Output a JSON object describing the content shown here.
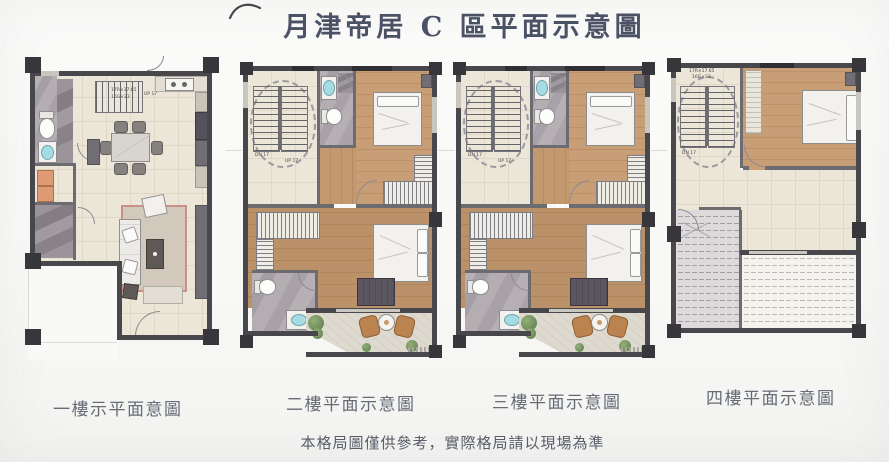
{
  "page": {
    "title": "月津帝居 C 區平面示意圖",
    "disclaimer": "本格局圖僅供參考，實際格局請以現場為準"
  },
  "floors": [
    {
      "label": "一樓示平面意圖",
      "stairs": {
        "up": "UP 17",
        "dim1": "17R×17.65",
        "dim2": "16G×23"
      }
    },
    {
      "label": "二樓平面示意圖",
      "stairs": {
        "dn": "DN 17",
        "up": "UP 17"
      }
    },
    {
      "label": "三樓平面示意圖",
      "stairs": {
        "dn": "DN 17",
        "up": "UP 17"
      }
    },
    {
      "label": "四樓平面示意圖",
      "stairs": {
        "dn": "DN 17",
        "dim1": "17R×17.65",
        "dim2": "16G×23"
      }
    }
  ],
  "colors": {
    "wall": "#47474c",
    "column": "#36363b",
    "cream_floor": "#ebe6d8",
    "wood_floor": "#c89e76",
    "marble_floor": "#b3adb2",
    "fixture_blue": "#a5dce3",
    "plant_green": "#7a9664",
    "rattan": "#bb8350",
    "title_text": "#4c5266",
    "label_text": "#666b76"
  }
}
